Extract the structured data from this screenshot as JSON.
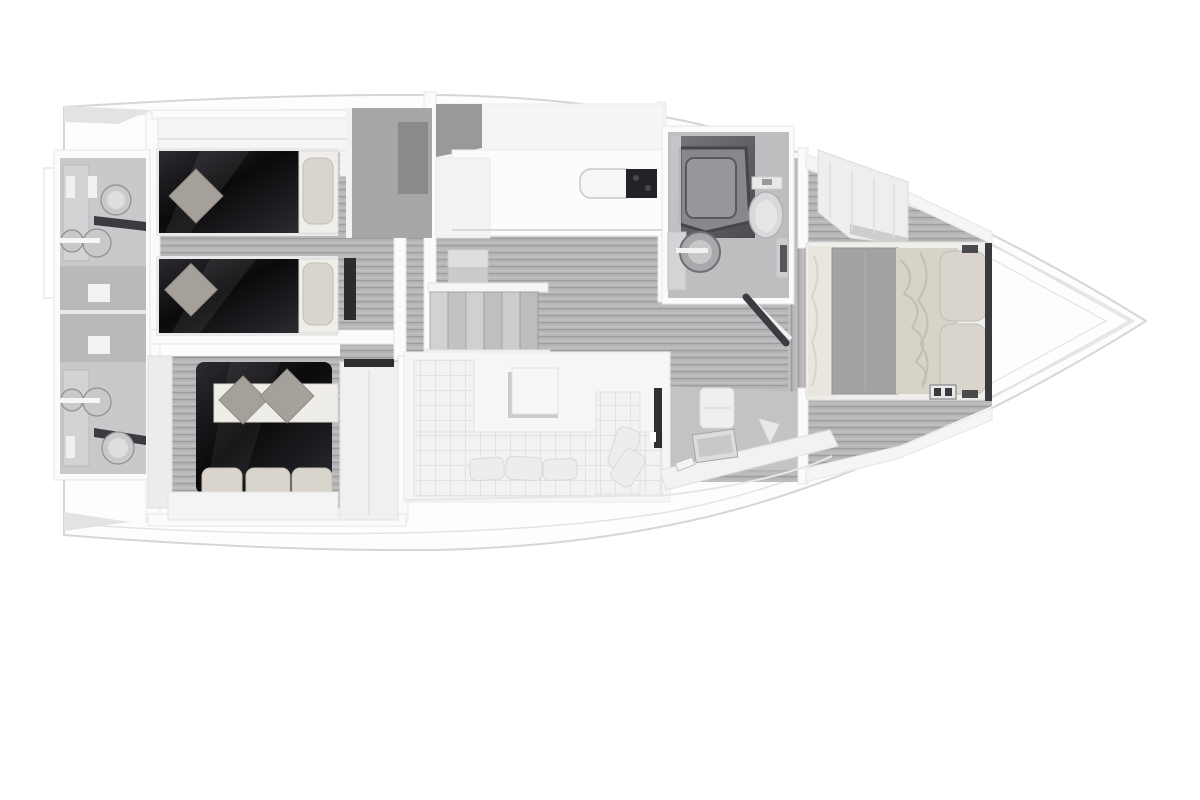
{
  "scene": {
    "type": "yacht-interior-floor-plan",
    "view": "top-down-3d-render",
    "orientation": "bow-right-stern-left",
    "rooms": [
      {
        "name": "aft-head-upper",
        "fixtures": [
          "sink",
          "sink",
          "toilet",
          "shelf",
          "vanity"
        ]
      },
      {
        "name": "aft-head-lower",
        "fixtures": [
          "sink",
          "sink",
          "toilet",
          "shelf",
          "vanity"
        ]
      },
      {
        "name": "guest-cabin-twin",
        "furniture": [
          "twin-bed",
          "twin-bed",
          "pillows",
          "cushions",
          "nightstand"
        ]
      },
      {
        "name": "guest-cabin-double",
        "furniture": [
          "double-bed",
          "folded-blanket",
          "cushions",
          "pillows",
          "wardrobe"
        ]
      },
      {
        "name": "companionway",
        "furniture": [
          "stairs",
          "handrail"
        ]
      },
      {
        "name": "galley",
        "furniture": [
          "counter",
          "sink",
          "cooktop"
        ]
      },
      {
        "name": "salon",
        "furniture": [
          "l-shaped-sofa",
          "coffee-table",
          "throw-pillows"
        ]
      },
      {
        "name": "forward-head",
        "fixtures": [
          "shower",
          "toilet",
          "sink",
          "vanity",
          "open-door"
        ]
      },
      {
        "name": "nav-desk-nook",
        "furniture": [
          "desk",
          "laptop",
          "chair"
        ]
      },
      {
        "name": "owner-cabin",
        "furniture": [
          "double-bed",
          "gray-blanket",
          "duvet",
          "pillows",
          "wardrobe",
          "side-benches"
        ]
      },
      {
        "name": "bow-deck",
        "furniture": []
      }
    ]
  },
  "palette": {
    "hull-edge": "#d6d6d8",
    "deck": "#f5f5f6",
    "deck-shadow": "#e3e3e5",
    "wall": "#fbfbfc",
    "wall-line": "#e6e6e8",
    "floor-base": "#b5b5b7",
    "floor-dark": "#9c9c9e",
    "floor-light": "#c7c7c9",
    "room-floor": "#bebec0",
    "bed-dark-1": "#0a0a0c",
    "bed-dark-2": "#2b2b30",
    "pillow": "#d9d5cc",
    "pillow-line": "#c3bfb4",
    "cushion": "#a5a19a",
    "blanket": "#a3a3a5",
    "duvet": "#d7d3c9",
    "mattress": "#efeeea",
    "sofa": "#f2f2f3",
    "sofa-line": "#e2e2e4",
    "glass1": "#4b4b50",
    "glass2": "#76767b",
    "tray": "#97979b",
    "fixture": "#c9c9cb",
    "fixture-dark": "#8e8e91",
    "shelf-dark": "#3c3c40",
    "cooktop": "#232327",
    "table": "#f7f7f8"
  }
}
